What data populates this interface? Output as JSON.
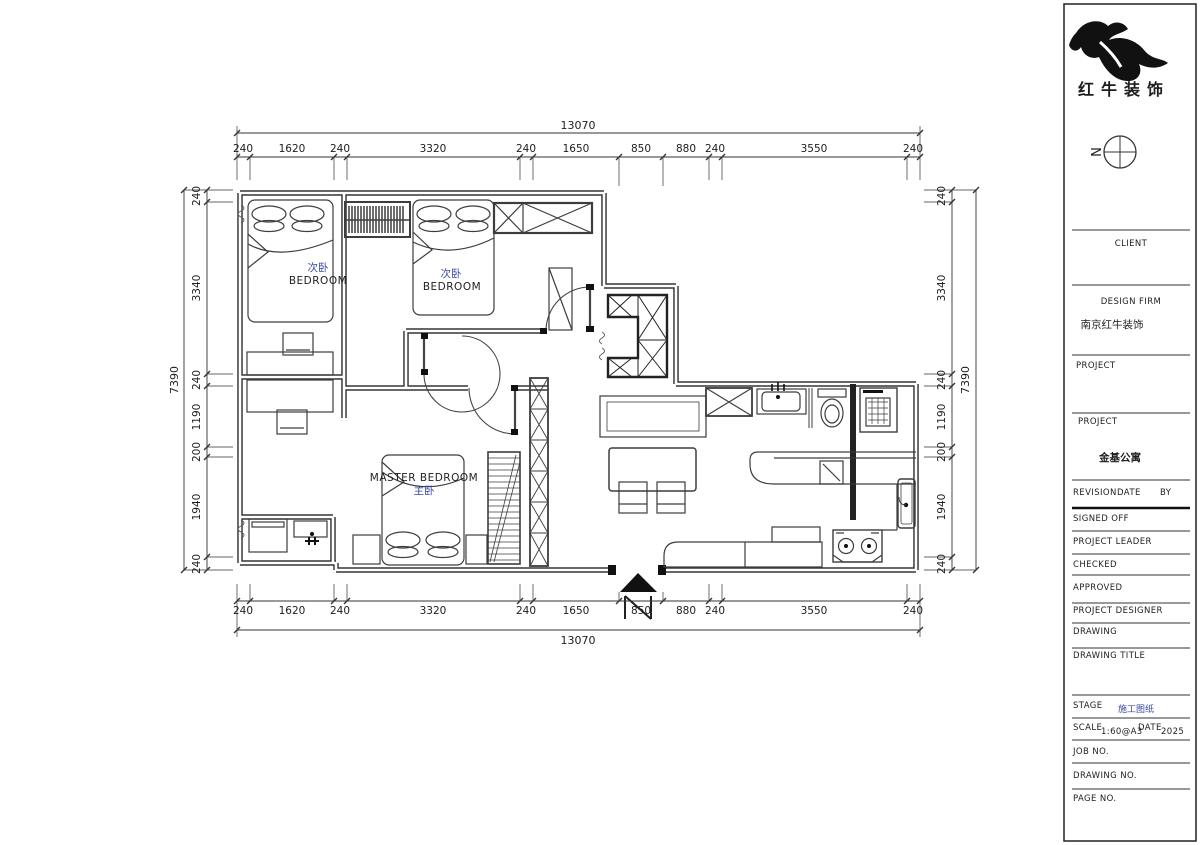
{
  "plan": {
    "rooms": {
      "bedroom1": {
        "zh": "次卧",
        "en": "BEDROOM"
      },
      "bedroom2": {
        "zh": "次卧",
        "en": "BEDROOM"
      },
      "master": {
        "en": "MASTER BEDROOM",
        "zh": "主卧"
      }
    },
    "dims": {
      "top": {
        "total": "13070",
        "segments": [
          "240",
          "1620",
          "240",
          "3320",
          "240",
          "1650",
          "850",
          "880",
          "240",
          "3550",
          "240"
        ]
      },
      "bottom": {
        "total": "13070",
        "segments": [
          "240",
          "1620",
          "240",
          "3320",
          "240",
          "1650",
          "850",
          "880",
          "240",
          "3550",
          "240"
        ]
      },
      "left": {
        "total": "7390",
        "segments": [
          "240",
          "3340",
          "240",
          "1190",
          "200",
          "1940",
          "240"
        ]
      },
      "right": {
        "total": "7390",
        "segments": [
          "240",
          "3340",
          "240",
          "1190",
          "200",
          "1940",
          "240"
        ]
      }
    }
  },
  "logo": {
    "name": "红牛装饰"
  },
  "compass": {
    "label": "N"
  },
  "titleblock": {
    "client_label": "CLIENT",
    "design_firm_label": "DESIGN FIRM",
    "design_firm_value": "南京红牛装饰",
    "project1_label": "PROJECT",
    "project2_label": "PROJECT",
    "project2_value": "金基公寓",
    "revision_label": "REVISION",
    "date_label": "DATE",
    "by_label": "BY",
    "signed_off_label": "SIGNED OFF",
    "project_leader_label": "PROJECT LEADER",
    "checked_label": "CHECKED",
    "approved_label": "APPROVED",
    "project_designer_label": "PROJECT DESIGNER",
    "drawing_label": "DRAWING",
    "drawing_title_label": "DRAWING TITLE",
    "stage_label": "STAGE",
    "stage_value": "施工图纸",
    "scale_label": "SCALE",
    "scale_value": "1:60@A3",
    "date2_label": "DATE",
    "date_value": "2025",
    "job_no_label": "JOB NO.",
    "drawing_no_label": "DRAWING NO.",
    "page_no_label": "PAGE NO."
  }
}
